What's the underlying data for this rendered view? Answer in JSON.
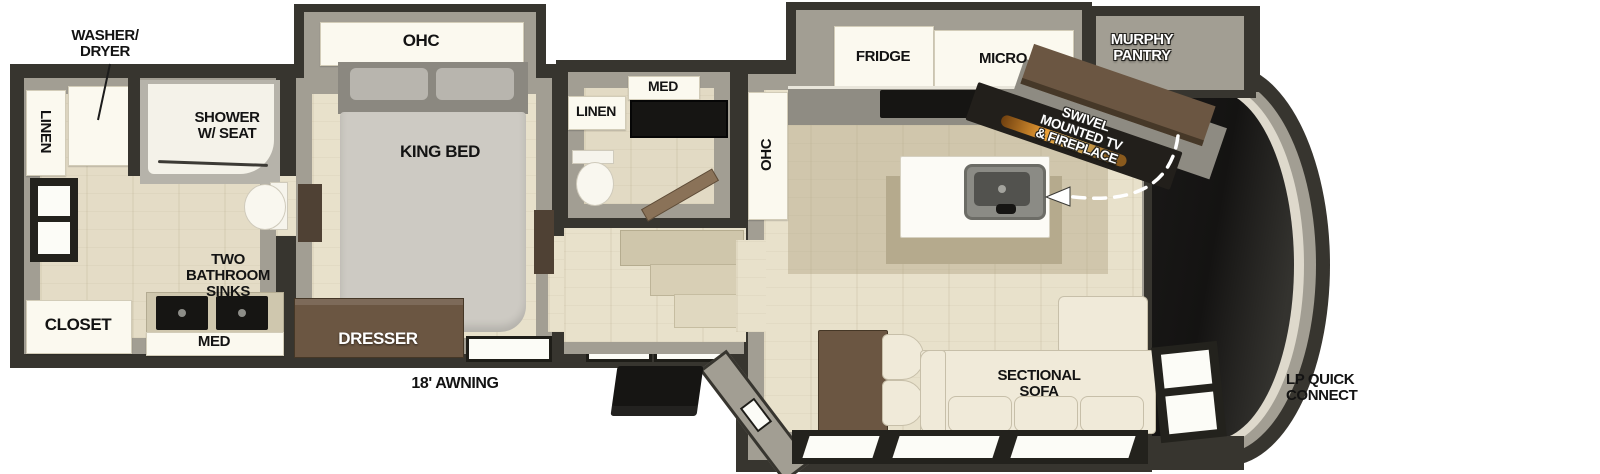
{
  "labels": {
    "washer_dryer": {
      "line1": "WASHER/",
      "line2": "DRYER"
    },
    "linen_rear": "LINEN",
    "shower": {
      "line1": "SHOWER",
      "line2": "W/ SEAT"
    },
    "bath_sinks": {
      "line1": "TWO",
      "line2": "BATHROOM",
      "line3": "SINKS"
    },
    "med_rear": "MED",
    "closet": "CLOSET",
    "ohc_bedroom": "OHC",
    "king_bed": "KING BED",
    "dresser": "DRESSER",
    "awning": "18' AWNING",
    "med_mid": "MED",
    "linen_mid": "LINEN",
    "ohc_living": "OHC",
    "fridge": "FRIDGE",
    "micro": "MICRO",
    "murphy_pantry": {
      "line1": "MURPHY",
      "line2": "PANTRY"
    },
    "swivel_tv": {
      "line1": "SWIVEL",
      "line2": "MOUNTED TV",
      "line3": "& FIREPLACE"
    },
    "sectional_sofa": {
      "line1": "SECTIONAL",
      "line2": "SOFA"
    },
    "lp_quick_connect": {
      "line1": "LP QUICK",
      "line2": "CONNECT"
    }
  },
  "colors": {
    "wall_dark": "#37352f",
    "wall_inner_gray": "#a29e93",
    "floor_beige": "#e8e1cb",
    "fixture_white": "#fbf9ef",
    "cabinet_brown": "#6b5642",
    "appliance_black": "#161513",
    "sofa_cream": "#f0ead9",
    "fireplace_glow": "#ec9f35",
    "label_black": "#131313",
    "label_white": "#ffffff"
  }
}
